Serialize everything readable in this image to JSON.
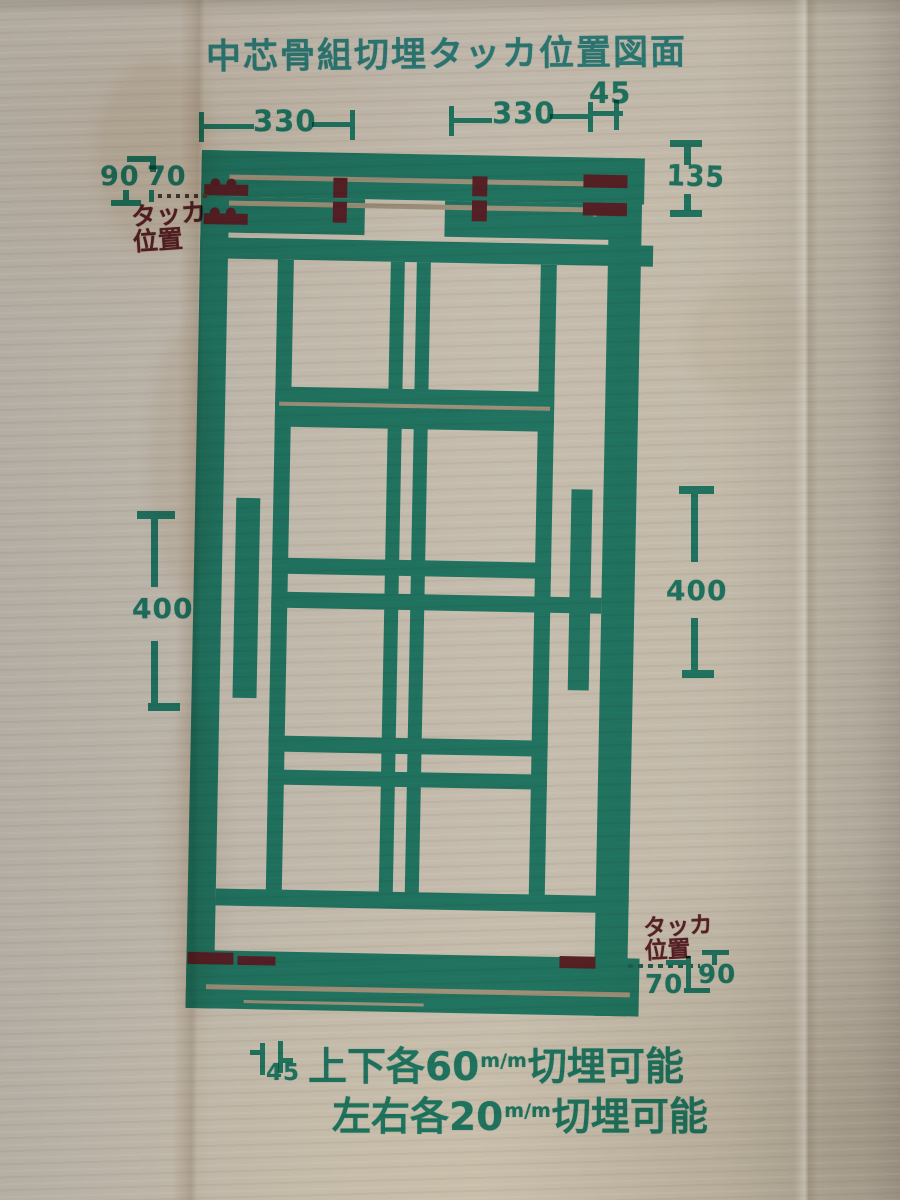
{
  "title": "中芯骨組切埋タッカ位置図面",
  "colors": {
    "ink_teal": "#2a9b8c",
    "title_teal": "#3aa2a8",
    "ink_maroon": "#6f2b36",
    "cardboard": "#c0b8aa"
  },
  "dimensions": {
    "top_left_330": "330",
    "top_right_330": "330",
    "top_right_45": "45",
    "right_135": "135",
    "left_90": "90",
    "left_70": "70",
    "left_400": "400",
    "right_400": "400",
    "bottom_70": "70",
    "bottom_90": "90",
    "bottom_45": "45"
  },
  "labels": {
    "stapler_top_line1": "タッカ",
    "stapler_top_line2": "位置",
    "stapler_bottom_line1": "タッカ",
    "stapler_bottom_line2": "位置"
  },
  "notes": {
    "line1_prefix": "上下各60",
    "line1_unit": "m/m",
    "line1_suffix": "切埋可能",
    "line2_prefix": "左右各20",
    "line2_unit": "m/m",
    "line2_suffix": "切埋可能"
  }
}
